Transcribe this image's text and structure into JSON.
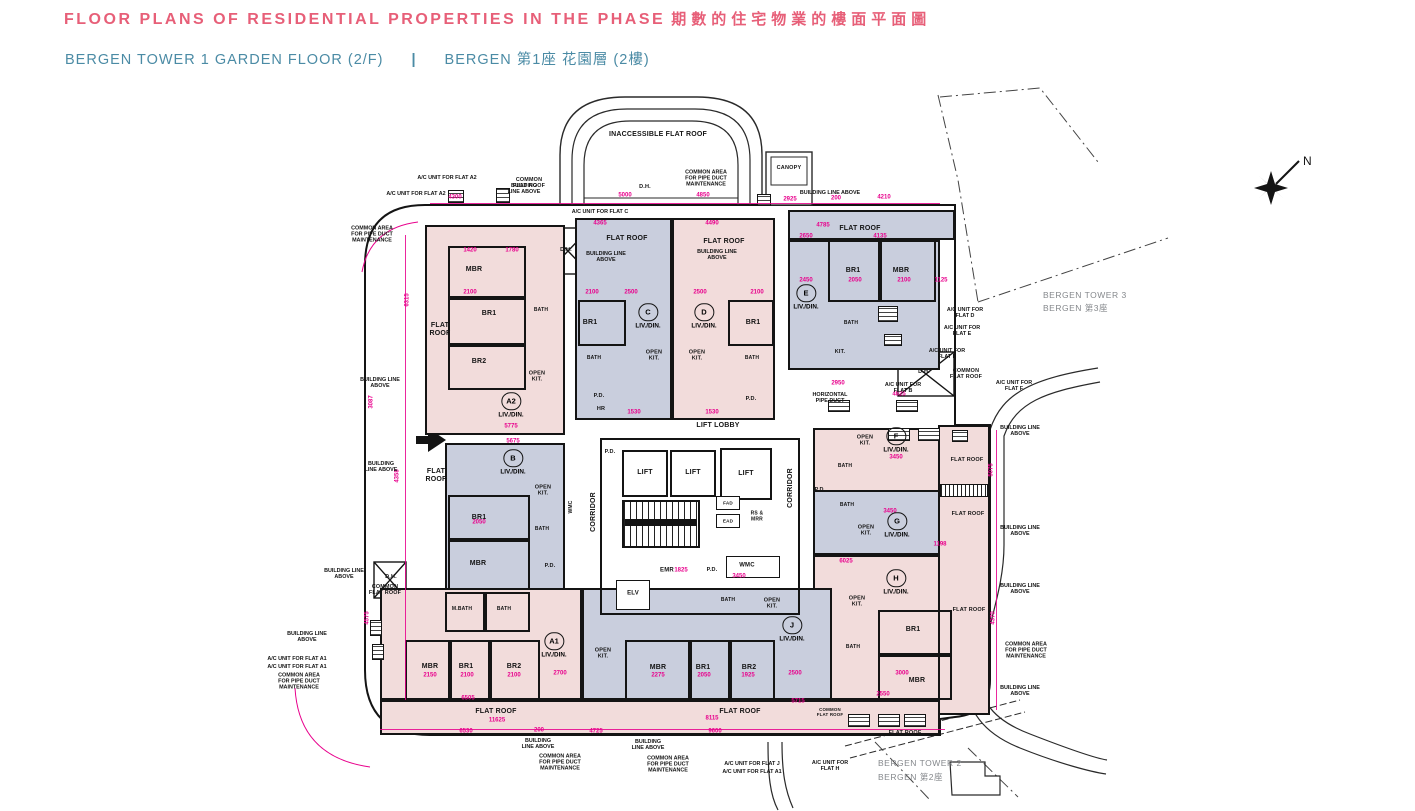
{
  "header": {
    "title_en": "FLOOR PLANS OF RESIDENTIAL PROPERTIES IN THE PHASE",
    "title_zh": "期數的住宅物業的樓面平面圖",
    "subtitle_en": "BERGEN TOWER 1  GARDEN FLOOR (2/F)",
    "subtitle_divider": "|",
    "subtitle_zh": "BERGEN 第1座 花園層 (2樓)"
  },
  "compass": {
    "label": "N"
  },
  "colors": {
    "title_pink": "#e75f78",
    "subtitle_teal": "#4b8ba5",
    "dimension_magenta": "#e8008c",
    "fill_pink": "#f2dcdb",
    "fill_blue": "#c9cedd"
  },
  "landmark_labels": [
    {
      "text": "BERGEN TOWER 3",
      "x": 1043,
      "y": 296
    },
    {
      "text": "BERGEN 第3座",
      "x": 1043,
      "y": 309
    },
    {
      "text": "BERGEN TOWER 2",
      "x": 878,
      "y": 764
    },
    {
      "text": "BERGEN 第2座",
      "x": 878,
      "y": 778
    }
  ],
  "unit_labels": [
    {
      "letter": "A2",
      "x": 511,
      "y": 404,
      "sub": "LIV./DIN."
    },
    {
      "letter": "B",
      "x": 513,
      "y": 461,
      "sub": "LIV./DIN."
    },
    {
      "letter": "C",
      "x": 648,
      "y": 315,
      "sub": "LIV./DIN."
    },
    {
      "letter": "D",
      "x": 704,
      "y": 315,
      "sub": "LIV./DIN."
    },
    {
      "letter": "E",
      "x": 806,
      "y": 296,
      "sub": "LIV./DIN."
    },
    {
      "letter": "F",
      "x": 896,
      "y": 439,
      "sub": "LIV./DIN."
    },
    {
      "letter": "G",
      "x": 897,
      "y": 524,
      "sub": "LIV./DIN."
    },
    {
      "letter": "H",
      "x": 896,
      "y": 581,
      "sub": "LIV./DIN."
    },
    {
      "letter": "J",
      "x": 792,
      "y": 628,
      "sub": "LIV./DIN."
    },
    {
      "letter": "A1",
      "x": 554,
      "y": 644,
      "sub": "LIV./DIN."
    }
  ],
  "room_labels": [
    {
      "text": "MBR",
      "x": 474,
      "y": 270
    },
    {
      "text": "BR1",
      "x": 489,
      "y": 314
    },
    {
      "text": "BR2",
      "x": 479,
      "y": 362
    },
    {
      "text": "FLAT\nROOF",
      "x": 440,
      "y": 330
    },
    {
      "text": "BATH",
      "x": 541,
      "y": 311,
      "fs": 5
    },
    {
      "text": "OPEN\nKIT.",
      "x": 537,
      "y": 377,
      "fs": 5.5
    },
    {
      "text": "BR1",
      "x": 590,
      "y": 323
    },
    {
      "text": "BATH",
      "x": 594,
      "y": 359,
      "fs": 5
    },
    {
      "text": "OPEN\nKIT.",
      "x": 654,
      "y": 356,
      "fs": 5.5
    },
    {
      "text": "P.D.",
      "x": 599,
      "y": 396,
      "fs": 5.5
    },
    {
      "text": "HR",
      "x": 601,
      "y": 409,
      "fs": 5.5
    },
    {
      "text": "BR1",
      "x": 753,
      "y": 323
    },
    {
      "text": "BATH",
      "x": 752,
      "y": 359,
      "fs": 5
    },
    {
      "text": "OPEN\nKIT.",
      "x": 697,
      "y": 356,
      "fs": 5.5
    },
    {
      "text": "P.D.",
      "x": 751,
      "y": 399,
      "fs": 5.5
    },
    {
      "text": "FLAT ROOF",
      "x": 627,
      "y": 239
    },
    {
      "text": "FLAT ROOF",
      "x": 724,
      "y": 242
    },
    {
      "text": "FLAT ROOF",
      "x": 860,
      "y": 229
    },
    {
      "text": "BR1",
      "x": 853,
      "y": 271
    },
    {
      "text": "MBR",
      "x": 901,
      "y": 271
    },
    {
      "text": "BATH",
      "x": 851,
      "y": 324,
      "fs": 5
    },
    {
      "text": "KIT.",
      "x": 840,
      "y": 352,
      "fs": 5.5
    },
    {
      "text": "FLAT\nROOF",
      "x": 436,
      "y": 476
    },
    {
      "text": "BR1",
      "x": 479,
      "y": 518
    },
    {
      "text": "MBR",
      "x": 478,
      "y": 564
    },
    {
      "text": "OPEN\nKIT.",
      "x": 543,
      "y": 491,
      "fs": 5.5
    },
    {
      "text": "BATH",
      "x": 542,
      "y": 530,
      "fs": 5
    },
    {
      "text": "P.D.",
      "x": 550,
      "y": 566,
      "fs": 5.5
    },
    {
      "text": "WMC",
      "x": 572,
      "y": 507,
      "rot": 1,
      "fs": 5
    },
    {
      "text": "OPEN\nKIT.",
      "x": 865,
      "y": 441,
      "fs": 5.5
    },
    {
      "text": "BATH",
      "x": 845,
      "y": 467,
      "fs": 5
    },
    {
      "text": "P.D.",
      "x": 820,
      "y": 490,
      "fs": 5.5
    },
    {
      "text": "OPEN\nKIT.",
      "x": 866,
      "y": 531,
      "fs": 5.5
    },
    {
      "text": "BATH",
      "x": 847,
      "y": 506,
      "fs": 5
    },
    {
      "text": "OPEN\nKIT.",
      "x": 857,
      "y": 602,
      "fs": 5.5
    },
    {
      "text": "BR1",
      "x": 913,
      "y": 630
    },
    {
      "text": "MBR",
      "x": 917,
      "y": 681
    },
    {
      "text": "BATH",
      "x": 853,
      "y": 648,
      "fs": 5
    },
    {
      "text": "MBR",
      "x": 658,
      "y": 668
    },
    {
      "text": "BR1",
      "x": 703,
      "y": 668
    },
    {
      "text": "BR2",
      "x": 749,
      "y": 668
    },
    {
      "text": "BATH",
      "x": 728,
      "y": 601,
      "fs": 5
    },
    {
      "text": "OPEN\nKIT.",
      "x": 772,
      "y": 604,
      "fs": 5.5
    },
    {
      "text": "OPEN\nKIT.",
      "x": 603,
      "y": 654,
      "fs": 5.5
    },
    {
      "text": "MBR",
      "x": 430,
      "y": 667
    },
    {
      "text": "BR1",
      "x": 466,
      "y": 667
    },
    {
      "text": "BR2",
      "x": 514,
      "y": 667
    },
    {
      "text": "M.BATH",
      "x": 462,
      "y": 610,
      "fs": 5
    },
    {
      "text": "BATH",
      "x": 504,
      "y": 610,
      "fs": 5
    },
    {
      "text": "LIFT LOBBY",
      "x": 718,
      "y": 426
    },
    {
      "text": "LIFT",
      "x": 645,
      "y": 473
    },
    {
      "text": "LIFT",
      "x": 693,
      "y": 473
    },
    {
      "text": "LIFT",
      "x": 746,
      "y": 474
    },
    {
      "text": "CORRIDOR",
      "x": 594,
      "y": 512,
      "rot": 1
    },
    {
      "text": "CORRIDOR",
      "x": 791,
      "y": 488,
      "rot": 1
    },
    {
      "text": "FAD",
      "x": 728,
      "y": 503,
      "fs": 4.6
    },
    {
      "text": "EAD",
      "x": 728,
      "y": 521,
      "fs": 4.6
    },
    {
      "text": "RS &\nMRR",
      "x": 757,
      "y": 517,
      "fs": 5
    },
    {
      "text": "EMR",
      "x": 667,
      "y": 571,
      "fs": 6
    },
    {
      "text": "ELV",
      "x": 633,
      "y": 594,
      "fs": 6
    },
    {
      "text": "P.D.",
      "x": 712,
      "y": 570,
      "fs": 5.5
    },
    {
      "text": "WMC",
      "x": 747,
      "y": 566,
      "fs": 6
    },
    {
      "text": "P.D.",
      "x": 610,
      "y": 452,
      "fs": 5.5
    },
    {
      "text": "FLAT ROOF",
      "x": 967,
      "y": 460,
      "fs": 5.5
    },
    {
      "text": "FLAT ROOF",
      "x": 968,
      "y": 514,
      "fs": 5.5
    },
    {
      "text": "FLAT ROOF",
      "x": 969,
      "y": 610,
      "fs": 5.5
    },
    {
      "text": "FLAT ROOF",
      "x": 905,
      "y": 733,
      "fs": 5.5
    },
    {
      "text": "FLAT ROOF",
      "x": 496,
      "y": 712
    },
    {
      "text": "FLAT ROOF",
      "x": 740,
      "y": 712
    },
    {
      "text": "COMMON\nFLAT ROOF",
      "x": 529,
      "y": 183,
      "fs": 5.4
    },
    {
      "text": "COMMON\nFLAT ROOF",
      "x": 966,
      "y": 374,
      "fs": 5.4
    },
    {
      "text": "COMMON\nFLAT ROOF",
      "x": 385,
      "y": 590,
      "fs": 5.4
    },
    {
      "text": "COMMON\nFLAT ROOF",
      "x": 830,
      "y": 712,
      "fs": 4.4
    },
    {
      "text": "INACCESSIBLE FLAT ROOF",
      "x": 658,
      "y": 135
    },
    {
      "text": "CANOPY",
      "x": 789,
      "y": 168,
      "fs": 5.5
    },
    {
      "text": "D.H.",
      "x": 645,
      "y": 187,
      "fs": 5.5
    },
    {
      "text": "D.H.",
      "x": 566,
      "y": 250,
      "fs": 5.5
    },
    {
      "text": "D.H.",
      "x": 924,
      "y": 372,
      "fs": 5.5
    },
    {
      "text": "D.H.",
      "x": 391,
      "y": 577,
      "fs": 5.5
    }
  ],
  "annotation_labels": [
    {
      "text": "A/C UNIT FOR FLAT A2",
      "x": 447,
      "y": 178
    },
    {
      "text": "A/C UNIT FOR FLAT A2",
      "x": 416,
      "y": 194
    },
    {
      "text": "A/C UNIT FOR FLAT C",
      "x": 600,
      "y": 212
    },
    {
      "text": "BUILDING\nLINE ABOVE",
      "x": 524,
      "y": 189
    },
    {
      "text": "BUILDING LINE\nABOVE",
      "x": 606,
      "y": 257
    },
    {
      "text": "BUILDING LINE\nABOVE",
      "x": 717,
      "y": 255
    },
    {
      "text": "BUILDING LINE ABOVE",
      "x": 830,
      "y": 193
    },
    {
      "text": "BUILDING LINE\nABOVE",
      "x": 380,
      "y": 383
    },
    {
      "text": "BUILDING LINE\nABOVE",
      "x": 344,
      "y": 574
    },
    {
      "text": "BUILDING LINE\nABOVE",
      "x": 307,
      "y": 637
    },
    {
      "text": "BUILDING\nLINE ABOVE",
      "x": 538,
      "y": 744
    },
    {
      "text": "BUILDING\nLINE ABOVE",
      "x": 648,
      "y": 745
    },
    {
      "text": "BUILDING LINE\nABOVE",
      "x": 1020,
      "y": 431
    },
    {
      "text": "BUILDING LINE\nABOVE",
      "x": 1020,
      "y": 531
    },
    {
      "text": "BUILDING LINE\nABOVE",
      "x": 1020,
      "y": 589
    },
    {
      "text": "BUILDING LINE\nABOVE",
      "x": 1020,
      "y": 691
    },
    {
      "text": "BUILDING\nLINE ABOVE",
      "x": 381,
      "y": 467
    },
    {
      "text": "COMMON AREA\nFOR PIPE DUCT\nMAINTENANCE",
      "x": 372,
      "y": 235
    },
    {
      "text": "COMMON AREA\nFOR PIPE DUCT\nMAINTENANCE",
      "x": 299,
      "y": 682
    },
    {
      "text": "COMMON AREA\nFOR PIPE DUCT\nMAINTENANCE",
      "x": 560,
      "y": 763
    },
    {
      "text": "COMMON AREA\nFOR PIPE DUCT\nMAINTENANCE",
      "x": 668,
      "y": 765
    },
    {
      "text": "COMMON AREA\nFOR PIPE DUCT\nMAINTENANCE",
      "x": 1026,
      "y": 651
    },
    {
      "text": "COMMON AREA\nFOR PIPE DUCT\nMAINTENANCE",
      "x": 706,
      "y": 179
    },
    {
      "text": "A/C UNIT FOR\nFLAT D",
      "x": 965,
      "y": 313
    },
    {
      "text": "A/C UNIT FOR\nFLAT E",
      "x": 962,
      "y": 331
    },
    {
      "text": "A/C UNIT FOR\nFLAT E",
      "x": 947,
      "y": 354
    },
    {
      "text": "A/C UNIT FOR\nFLAT B",
      "x": 903,
      "y": 388
    },
    {
      "text": "A/C UNIT FOR\nFLAT F",
      "x": 1014,
      "y": 386
    },
    {
      "text": "A/C UNIT FOR FLAT A1",
      "x": 297,
      "y": 659
    },
    {
      "text": "A/C UNIT FOR FLAT A1",
      "x": 297,
      "y": 667
    },
    {
      "text": "A/C UNIT FOR FLAT J",
      "x": 752,
      "y": 764
    },
    {
      "text": "A/C UNIT FOR FLAT A1",
      "x": 752,
      "y": 772
    },
    {
      "text": "A/C UNIT FOR\nFLAT H",
      "x": 830,
      "y": 766
    },
    {
      "text": "HORIZONTAL\nPIPE DUCT",
      "x": 830,
      "y": 398
    }
  ],
  "dim_labels": [
    {
      "text": "4300",
      "x": 455,
      "y": 198
    },
    {
      "text": "5000",
      "x": 625,
      "y": 196
    },
    {
      "text": "4850",
      "x": 703,
      "y": 196
    },
    {
      "text": "2925",
      "x": 790,
      "y": 200
    },
    {
      "text": "200",
      "x": 836,
      "y": 199
    },
    {
      "text": "4210",
      "x": 884,
      "y": 198
    },
    {
      "text": "4365",
      "x": 600,
      "y": 224
    },
    {
      "text": "4490",
      "x": 712,
      "y": 224
    },
    {
      "text": "4785",
      "x": 823,
      "y": 226
    },
    {
      "text": "2650",
      "x": 806,
      "y": 237
    },
    {
      "text": "4135",
      "x": 880,
      "y": 237
    },
    {
      "text": "1420",
      "x": 470,
      "y": 251
    },
    {
      "text": "1780",
      "x": 512,
      "y": 251
    },
    {
      "text": "2100",
      "x": 470,
      "y": 293
    },
    {
      "text": "2100",
      "x": 592,
      "y": 293
    },
    {
      "text": "2500",
      "x": 631,
      "y": 293
    },
    {
      "text": "2500",
      "x": 700,
      "y": 293
    },
    {
      "text": "2100",
      "x": 757,
      "y": 293
    },
    {
      "text": "2450",
      "x": 806,
      "y": 281
    },
    {
      "text": "2050",
      "x": 855,
      "y": 281
    },
    {
      "text": "2100",
      "x": 904,
      "y": 281
    },
    {
      "text": "1125",
      "x": 941,
      "y": 281
    },
    {
      "text": "6315",
      "x": 408,
      "y": 300,
      "rot": 1
    },
    {
      "text": "3087",
      "x": 372,
      "y": 402,
      "rot": 1
    },
    {
      "text": "4358",
      "x": 398,
      "y": 476,
      "rot": 1
    },
    {
      "text": "4575",
      "x": 368,
      "y": 618,
      "rot": 1
    },
    {
      "text": "5775",
      "x": 511,
      "y": 427
    },
    {
      "text": "5675",
      "x": 513,
      "y": 442
    },
    {
      "text": "2050",
      "x": 479,
      "y": 523
    },
    {
      "text": "3450",
      "x": 896,
      "y": 458
    },
    {
      "text": "3450",
      "x": 890,
      "y": 512
    },
    {
      "text": "6025",
      "x": 846,
      "y": 562
    },
    {
      "text": "2950",
      "x": 838,
      "y": 384
    },
    {
      "text": "4825",
      "x": 899,
      "y": 395
    },
    {
      "text": "3450",
      "x": 739,
      "y": 577
    },
    {
      "text": "1825",
      "x": 681,
      "y": 571
    },
    {
      "text": "1530",
      "x": 634,
      "y": 413
    },
    {
      "text": "1530",
      "x": 712,
      "y": 413
    },
    {
      "text": "2150",
      "x": 430,
      "y": 676
    },
    {
      "text": "2100",
      "x": 467,
      "y": 676
    },
    {
      "text": "2100",
      "x": 514,
      "y": 676
    },
    {
      "text": "2700",
      "x": 560,
      "y": 674
    },
    {
      "text": "2275",
      "x": 658,
      "y": 676
    },
    {
      "text": "2050",
      "x": 704,
      "y": 676
    },
    {
      "text": "1925",
      "x": 748,
      "y": 676
    },
    {
      "text": "2500",
      "x": 795,
      "y": 674
    },
    {
      "text": "6505",
      "x": 468,
      "y": 699
    },
    {
      "text": "11625",
      "x": 497,
      "y": 721
    },
    {
      "text": "6530",
      "x": 466,
      "y": 732
    },
    {
      "text": "200",
      "x": 539,
      "y": 731
    },
    {
      "text": "4725",
      "x": 596,
      "y": 732
    },
    {
      "text": "9600",
      "x": 715,
      "y": 732
    },
    {
      "text": "5715",
      "x": 798,
      "y": 702
    },
    {
      "text": "8115",
      "x": 712,
      "y": 719
    },
    {
      "text": "3000",
      "x": 902,
      "y": 674
    },
    {
      "text": "2550",
      "x": 883,
      "y": 695
    },
    {
      "text": "1198",
      "x": 940,
      "y": 545
    },
    {
      "text": "5075",
      "x": 992,
      "y": 470,
      "rot": 1
    },
    {
      "text": "4370",
      "x": 994,
      "y": 618,
      "rot": 1
    }
  ]
}
